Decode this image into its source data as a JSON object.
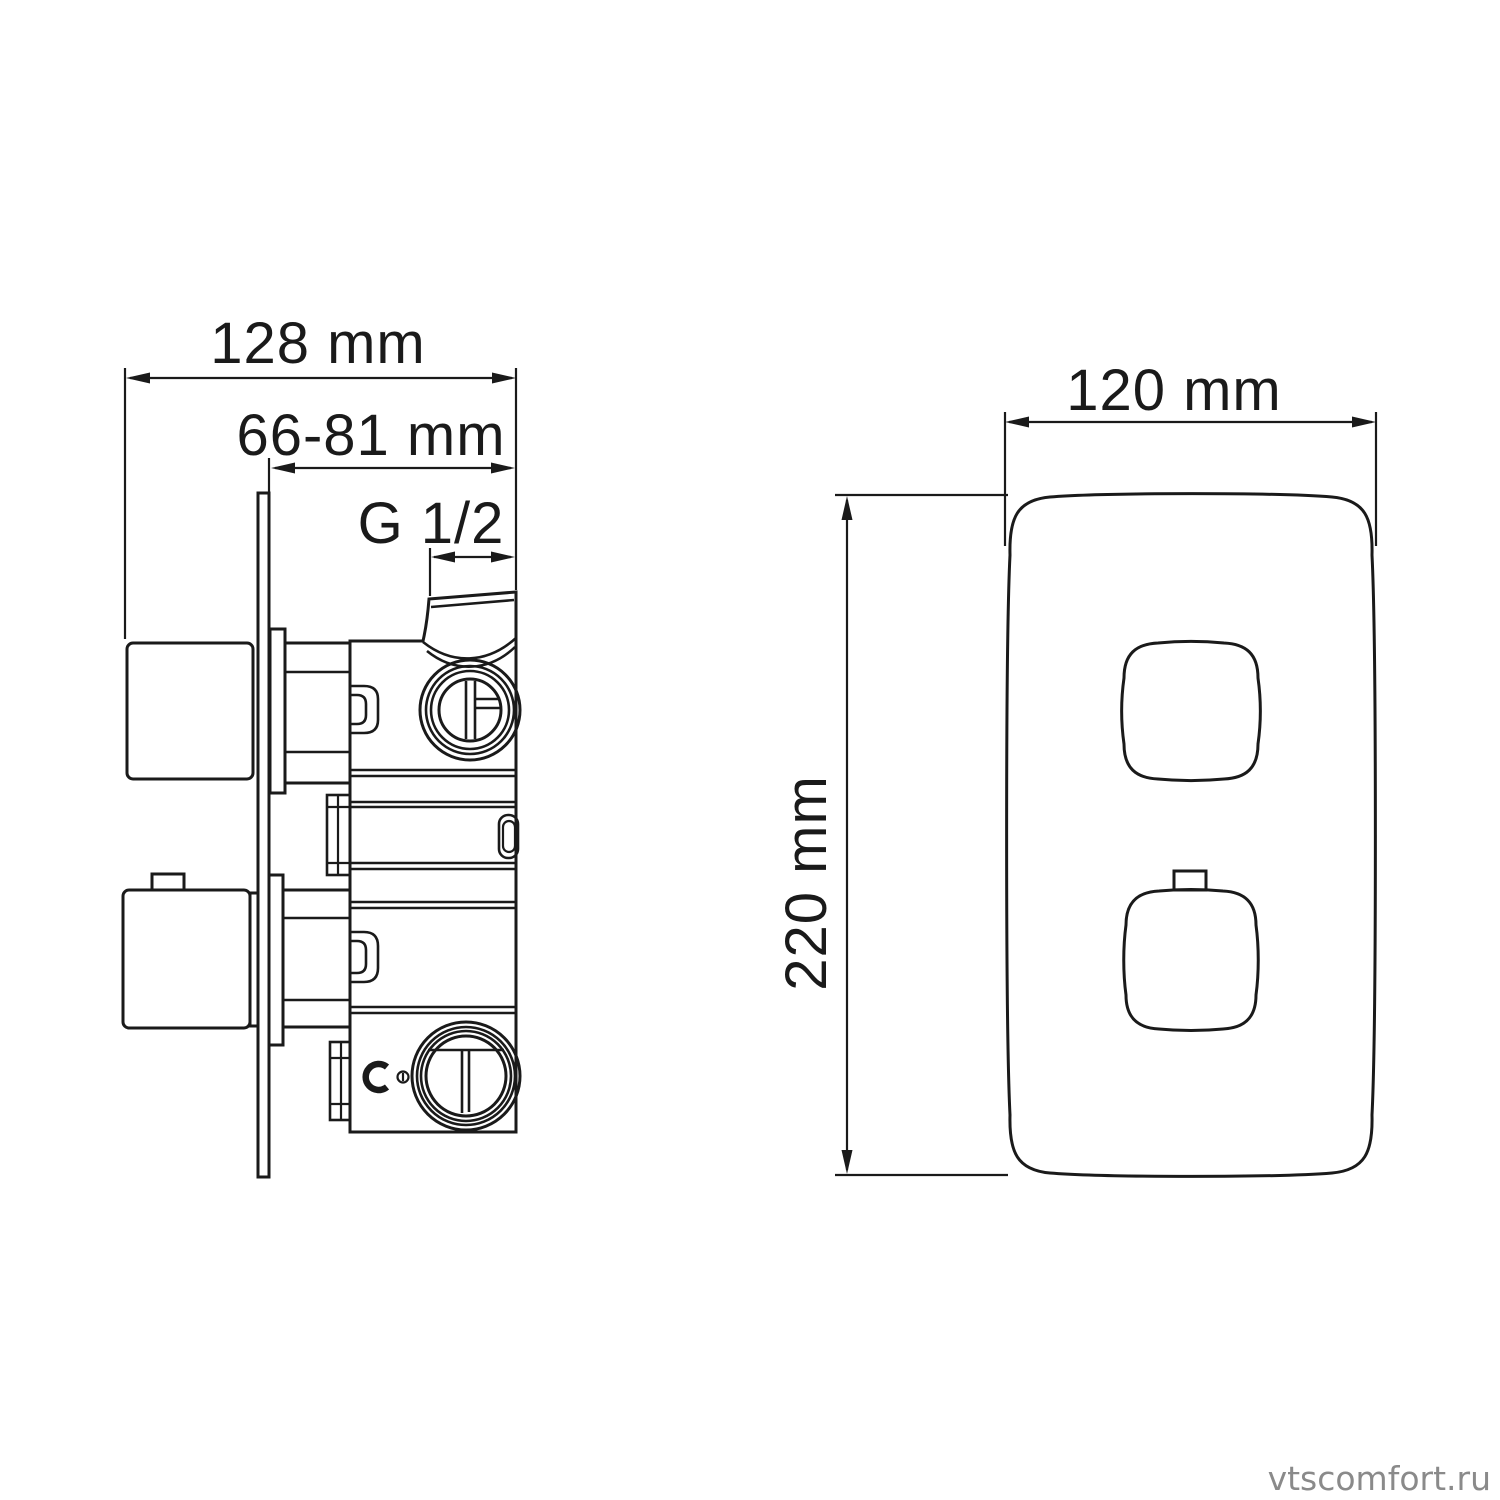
{
  "colors": {
    "background": "#ffffff",
    "line": "#1a1a1a",
    "dimension_text": "#1a1a1a",
    "watermark": "#8a8a8a"
  },
  "side_view": {
    "description_labels": {
      "overall_width": {
        "label": "128 mm"
      },
      "mounting_depth_range": {
        "label": "66-81 mm"
      },
      "inlet_thread": {
        "label": "G 1/2"
      }
    }
  },
  "front_view": {
    "description_labels": {
      "plate_width": {
        "label": "120 mm"
      },
      "plate_height": {
        "label": "220 mm"
      }
    }
  },
  "watermark": {
    "text": "vtscomfort.ru"
  }
}
